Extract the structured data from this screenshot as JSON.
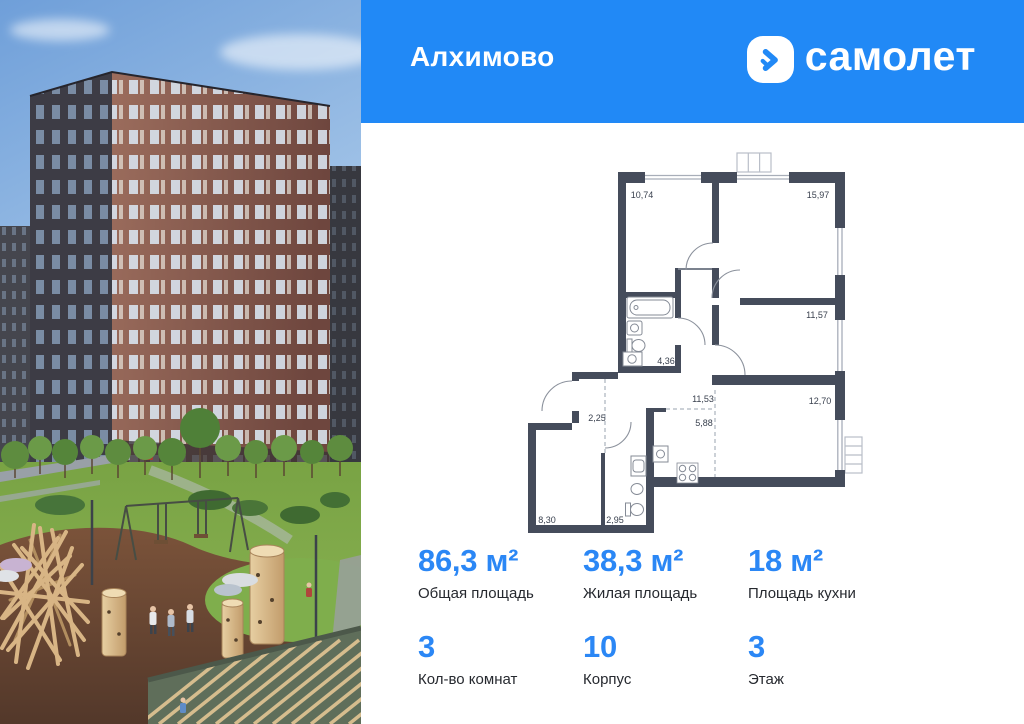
{
  "header": {
    "project_name": "Алхимово",
    "brand_name": "самолет"
  },
  "floor_plan": {
    "rooms": [
      {
        "area": "10,74"
      },
      {
        "area": "15,97"
      },
      {
        "area": "11,57"
      },
      {
        "area": "4,36"
      },
      {
        "area": "2,25"
      },
      {
        "area": "11,53"
      },
      {
        "area": "5,88"
      },
      {
        "area": "12,70"
      },
      {
        "area": "8,30"
      },
      {
        "area": "2,95"
      }
    ]
  },
  "stats": {
    "primary": [
      {
        "value": "86,3 м²",
        "label": "Общая площадь"
      },
      {
        "value": "38,3 м²",
        "label": "Жилая площадь"
      },
      {
        "value": "18 м²",
        "label": "Площадь кухни"
      }
    ],
    "secondary": [
      {
        "value": "3",
        "label": "Кол-во комнат"
      },
      {
        "value": "10",
        "label": "Корпус"
      },
      {
        "value": "3",
        "label": "Этаж"
      }
    ]
  },
  "colors": {
    "accent_blue": "#2b87f5",
    "header_blue": "#2189f6",
    "plan_wall": "#454c5b"
  }
}
